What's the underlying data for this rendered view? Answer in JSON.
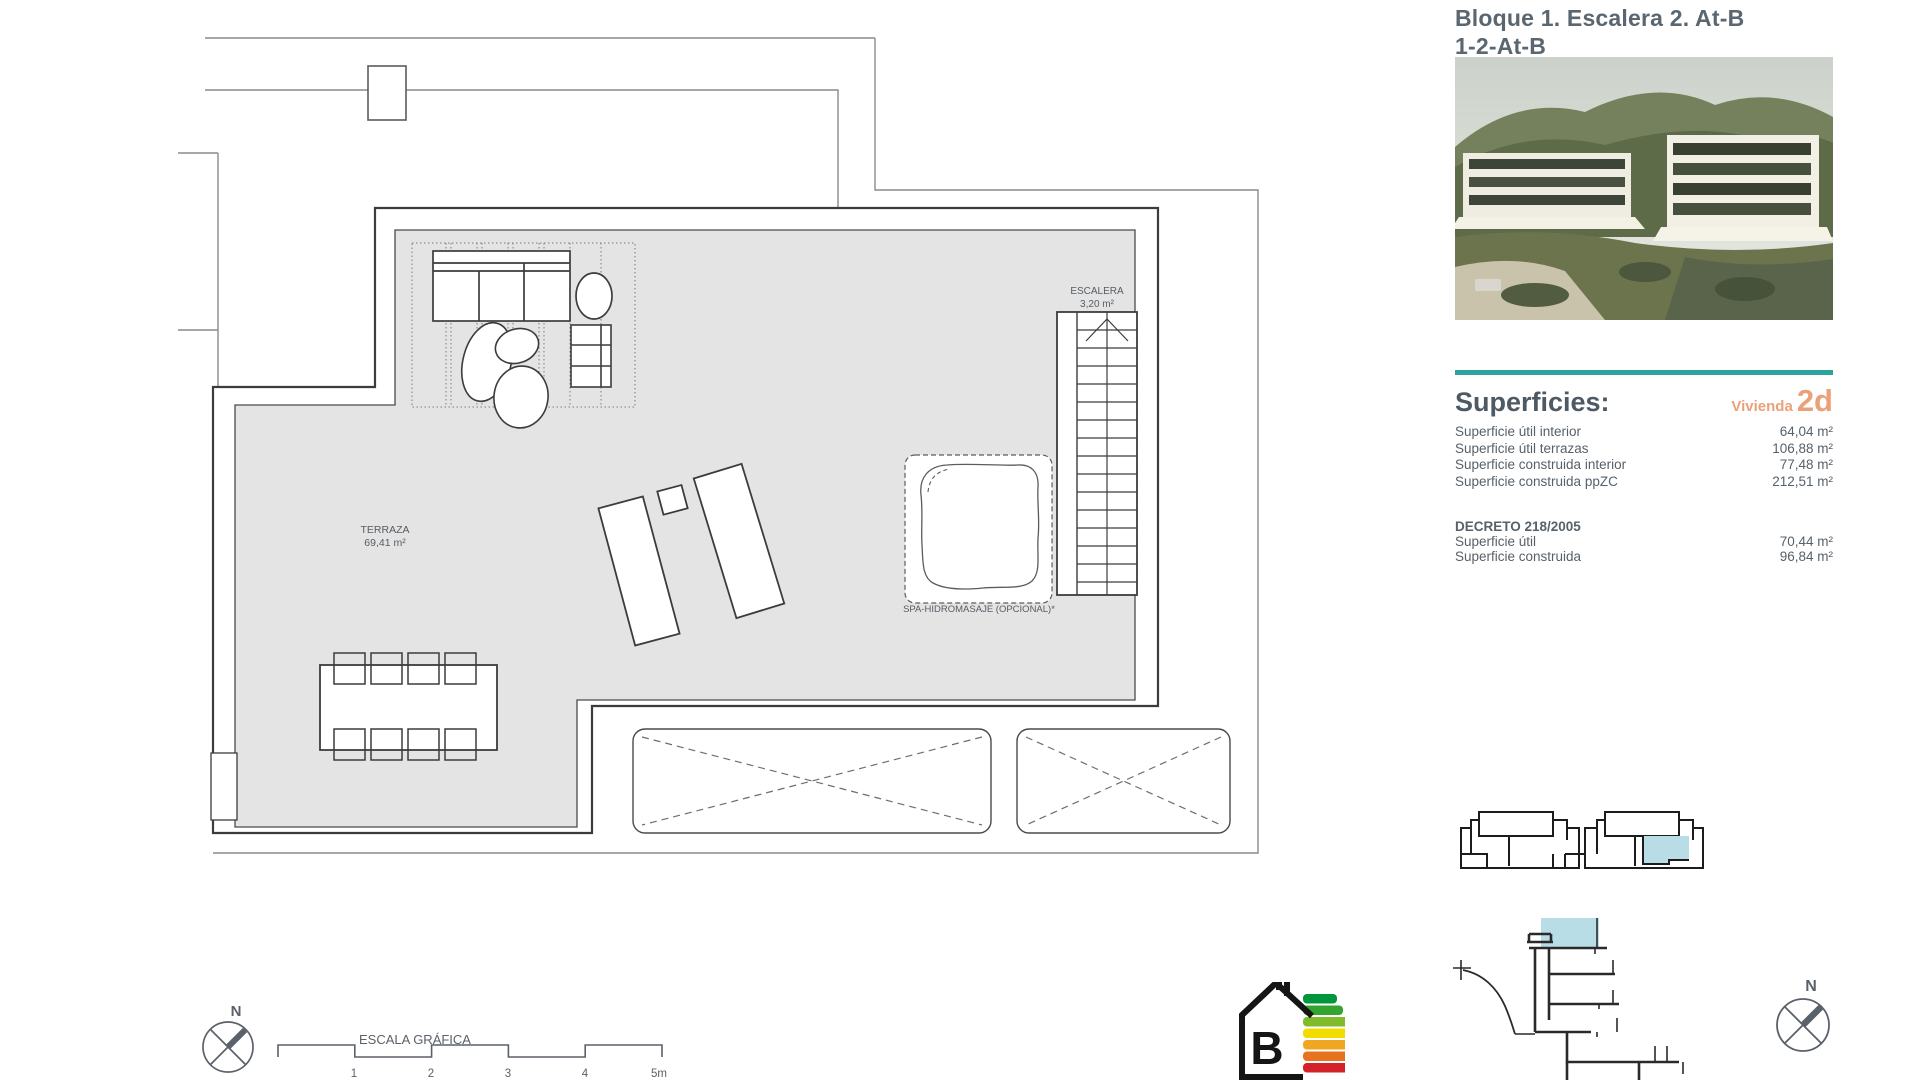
{
  "header": {
    "title_line1": "Bloque 1. Escalera 2. At-B",
    "title_line2": "1-2-At-B"
  },
  "plan": {
    "terraza_label": "TERRAZA",
    "terraza_area": "69,41 m²",
    "escalera_label": "ESCALERA",
    "escalera_area": "3,20 m²",
    "spa_label": "SPA-HIDROMASAJE (OPCIONAL)*",
    "scale_bar": {
      "title": "ESCALA GRÁFICA",
      "ticks": [
        "1",
        "2",
        "3",
        "4",
        "5m"
      ]
    },
    "compass_label": "N"
  },
  "superficies": {
    "heading": "Superficies:",
    "vivienda_label": "Vivienda",
    "vivienda_code": "2d",
    "rows": [
      {
        "label": "Superficie útil interior",
        "value": "64,04 m²"
      },
      {
        "label": "Superficie útil terrazas",
        "value": "106,88 m²"
      },
      {
        "label": "Superficie construida interior",
        "value": "77,48 m²"
      },
      {
        "label": "Superficie construida ppZC",
        "value": "212,51 m²"
      }
    ],
    "decreto": {
      "heading": "DECRETO 218/2005",
      "rows": [
        {
          "label": "Superficie útil",
          "value": "70,44 m²"
        },
        {
          "label": "Superficie construida",
          "value": "96,84 m²"
        }
      ]
    }
  },
  "energy": {
    "letter": "B",
    "colors": [
      "#00963b",
      "#33a52e",
      "#7fbb2a",
      "#f2dc00",
      "#efa722",
      "#e8731e",
      "#d4212a"
    ]
  },
  "colors": {
    "accent_teal": "#29a59e",
    "accent_orange": "#eaa179",
    "title_gray": "#5a6670",
    "plan_fill": "#e4e4e4",
    "highlight_blue": "#b9dde6"
  }
}
